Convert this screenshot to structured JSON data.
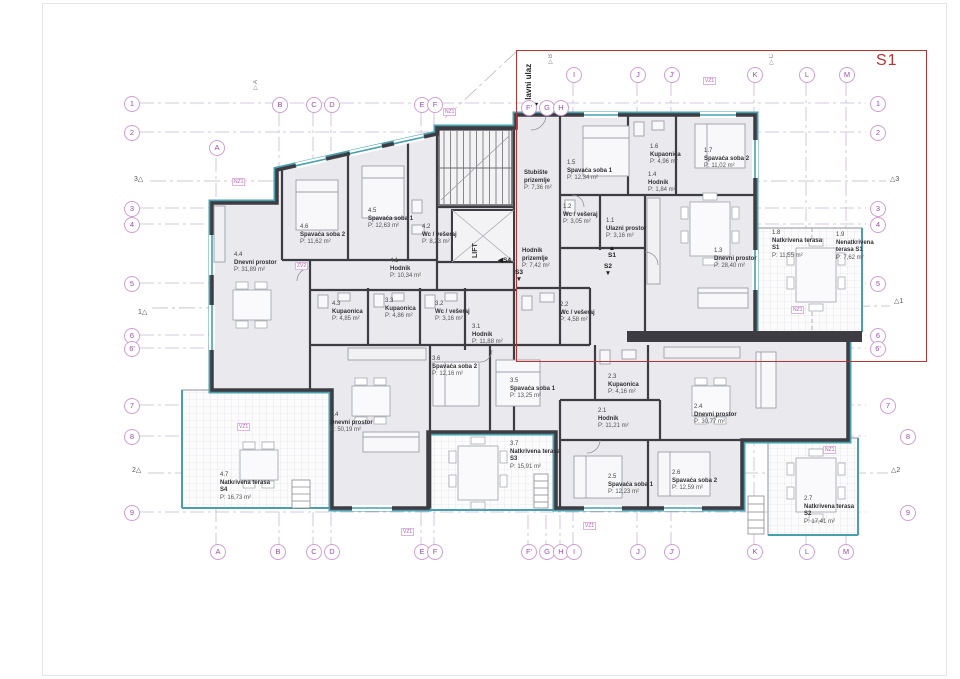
{
  "title": "S1",
  "entrance_label": "Glavni ulaz",
  "lift_label": "LIFT",
  "glyphs": {
    "up": "▲",
    "down": "▼",
    "left": "◀"
  },
  "colors": {
    "accent_teal": "#4a9fae",
    "wall": "#3c3c42",
    "red": "#b53434",
    "grid_purple": "#b79fc7",
    "bubble": "#9a4fae"
  },
  "grid": {
    "top": [
      "B",
      "C",
      "D",
      "E",
      "F",
      "F'",
      "G",
      "H",
      "I",
      "J",
      "J'",
      "K",
      "L",
      "M"
    ],
    "corner_a": "A",
    "bottom": [
      "A",
      "B",
      "C",
      "D",
      "E",
      "F",
      "F'",
      "G",
      "H",
      "I",
      "J",
      "J'",
      "K",
      "L",
      "M"
    ],
    "left": [
      "1",
      "2",
      "3",
      "4",
      "5",
      "6",
      "6'",
      "7",
      "8",
      "9"
    ],
    "right": [
      "1",
      "2",
      "3",
      "4",
      "5",
      "6",
      "6'",
      "7",
      "8",
      "9"
    ],
    "left_markers": [
      "3△",
      "1△",
      "2△"
    ],
    "right_markers": [
      "△3",
      "△1",
      "△2"
    ]
  },
  "section_arrows": [
    "▽A",
    "▽B",
    "▽C"
  ],
  "stair_marks": {
    "s1": "S1",
    "s2": "S2",
    "s3": "S3",
    "s4": "S4"
  },
  "tags": [
    "NZ1",
    "VZ1",
    "NZ1",
    "VZ1",
    "VZ1",
    "VZ1",
    "ZV2",
    "NZ1",
    "NZ1"
  ],
  "rooms": [
    {
      "id": "1.1",
      "name": "Ulazni prostor",
      "area": "P: 3,16 m²"
    },
    {
      "id": "1.2",
      "name": "Wc / vešeraj",
      "area": "P: 3,05 m²"
    },
    {
      "id": "1.3",
      "name": "Dnevni prostor",
      "area": "P: 28,40 m²"
    },
    {
      "id": "1.4",
      "name": "Hodnik",
      "area": "P: 1,84 m²"
    },
    {
      "id": "1.5",
      "name": "Spavaća soba 1",
      "area": "P: 12,34 m²"
    },
    {
      "id": "1.6",
      "name": "Kupaonica",
      "area": "P: 4,96 m²"
    },
    {
      "id": "1.7",
      "name": "Spavaća soba 2",
      "area": "P: 11,02 m²"
    },
    {
      "id": "1.8",
      "name": "Natkrivena terasa S1",
      "area": "P: 11,55 m²"
    },
    {
      "id": "1.9",
      "name": "Nenatkrivena terasa S1",
      "area": "P: 7,62 m²"
    },
    {
      "id": "2.1",
      "name": "Hodnik",
      "area": "P: 11,21 m²"
    },
    {
      "id": "2.2",
      "name": "Wc / vešeraj",
      "area": "P: 4,58 m²"
    },
    {
      "id": "2.3",
      "name": "Kupaonica",
      "area": "P: 4,16 m²"
    },
    {
      "id": "2.4",
      "name": "Dnevni prostor",
      "area": "P: 30,77 m²"
    },
    {
      "id": "2.5",
      "name": "Spavaća soba 1",
      "area": "P: 12,23 m²"
    },
    {
      "id": "2.6",
      "name": "Spavaća soba 2",
      "area": "P: 12,59 m²"
    },
    {
      "id": "2.7",
      "name": "Natkrivena terasa S2",
      "area": "P: 17,41 m²"
    },
    {
      "id": "3.1",
      "name": "Hodnik",
      "area": "P: 11,88 m²"
    },
    {
      "id": "3.2",
      "name": "Wc / vešeraj",
      "area": "P: 3,16 m²"
    },
    {
      "id": "3.3",
      "name": "Kupaonica",
      "area": "P: 4,86 m²"
    },
    {
      "id": "3.4",
      "name": "Dnevni prostor",
      "area": "P: 50,19 m²"
    },
    {
      "id": "3.5",
      "name": "Spavaća soba 1",
      "area": "P: 13,25 m²"
    },
    {
      "id": "3.6",
      "name": "Spavaća soba 2",
      "area": "P: 12,16 m²"
    },
    {
      "id": "3.7",
      "name": "Natkrivena terasa S3",
      "area": "P: 15,91 m²"
    },
    {
      "id": "4.1",
      "name": "Hodnik",
      "area": "P: 10,34 m²"
    },
    {
      "id": "4.2",
      "name": "Wc / vešeraj",
      "area": "P: 8,23 m²"
    },
    {
      "id": "4.3",
      "name": "Kupaonica",
      "area": "P: 4,85 m²"
    },
    {
      "id": "4.4",
      "name": "Dnevni prostor",
      "area": "P: 31,89 m²"
    },
    {
      "id": "4.5",
      "name": "Spavaća soba 1",
      "area": "P: 12,63 m²"
    },
    {
      "id": "4.6",
      "name": "Spavaća soba 2",
      "area": "P: 11,62 m²"
    },
    {
      "id": "4.7",
      "name": "Natkrivena terasa S4",
      "area": "P: 16,73 m²"
    },
    {
      "id": "",
      "name": "Stubište prizemlje",
      "area": "P: 7,36 m²"
    },
    {
      "id": "",
      "name": "Hodnik prizemlje",
      "area": "P: 7,42 m²"
    }
  ]
}
